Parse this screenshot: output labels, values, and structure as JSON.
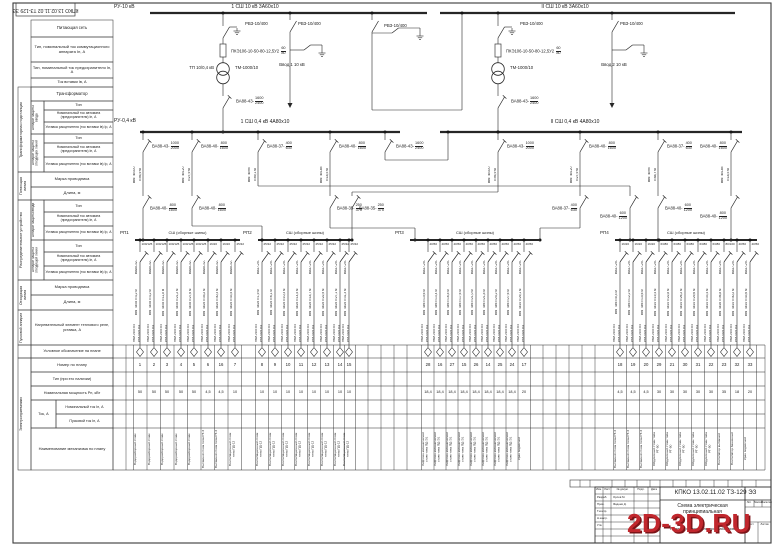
{
  "stamp": {
    "doc": "КПКО 13.02.11.02 ТЗ-129 ЭЗ"
  },
  "watermark": "2D-3D.RU",
  "hv": {
    "ru": "РУ-10 кВ",
    "bus1": "1 СШ 10 кВ  3А60х10",
    "bus2": "II СШ 10 кВ  3А60х10",
    "bays": [
      {
        "x": 223,
        "disc": "РВЗ-10/400",
        "fuse": "ПКЭ106-10-50-80-12,5У2",
        "fuse_frac": "60/80",
        "tp": "ТП 10/0,4 кВ",
        "tr": "ТМ-1000/10",
        "brk_t": "ВА88-43-",
        "brk_f": "1600/2400"
      },
      {
        "x": 498,
        "disc": "РВЗ-10/400",
        "fuse": "ПКЭ106-10-50-80-12,5У2",
        "fuse_frac": "60/80",
        "tp": "",
        "tr": "ТМ-1000/10",
        "brk_t": "ВА88-43-",
        "brk_f": "1600/2400"
      }
    ],
    "incomers": [
      {
        "x": 290,
        "disc": "РВЗ-10/400",
        "label": "Ввод 1 10 кВ"
      },
      {
        "x": 612,
        "disc": "РВЗ-10/400",
        "label": "Ввод 2 10 кВ"
      }
    ],
    "section": {
      "x": 372,
      "disc": "РВЗ-10/400"
    }
  },
  "lv": {
    "ru": "РУ-0,4 кВ",
    "bus1": "1 СШ 0,4 кВ  4А80х10",
    "bus2": "II СШ 0,4 кВ  4А80х10",
    "tie": {
      "t": "ВА88-43-",
      "f": "1600/2400"
    },
    "feeders": [
      {
        "x": 143,
        "top_t": "ВА88-43-",
        "top_f": "1000/2000",
        "cable": "ВВГ 4х300",
        "len": "l=56,9 м",
        "low_t": "ВА88-40-",
        "low_f": "800/1600",
        "route": "s",
        "land": 143
      },
      {
        "x": 192,
        "top_t": "ВА88-40-",
        "top_f": "800/1600",
        "cable": "ВВГ 4х120",
        "len": "l=27,9 м",
        "low_t": "ВА88-40-",
        "low_f": "800/1600",
        "route": "jog",
        "jy": 226,
        "land": 262
      },
      {
        "x": 258,
        "top_t": "ВА88-37-",
        "top_f": "400/630",
        "cable": "ВВГ 4х95",
        "len": "l=49,1 м",
        "low_t": "ВА88-40-",
        "low_f": "600/1200",
        "route": "H",
        "hy": 186,
        "land": 630
      },
      {
        "x": 330,
        "top_t": "ВА88-40-",
        "top_f": "800/1600",
        "cable": "ВВГ 4х185",
        "len": "l=18,5 м",
        "low_t": "ВА88-35-",
        "low_f": "250/375",
        "route": "jog",
        "jy": 228,
        "land": 415
      },
      {
        "x": 498,
        "top_t": "ВА88-43-",
        "top_f": "1000/2000",
        "cable": "ВВГ 4х300",
        "len": "l=56,9 м",
        "low_t": "ВА88-35-",
        "low_f": "250/375",
        "route": "H",
        "hy": 192,
        "land": 352
      },
      {
        "x": 580,
        "top_t": "ВА88-40-",
        "top_f": "800/1600",
        "cable": "ВВГ 4х120",
        "len": "l=27,9 м",
        "low_t": "ВА88-37-",
        "low_f": "400/630",
        "route": "jog",
        "jy": 228,
        "land": 540
      },
      {
        "x": 658,
        "top_t": "ВА88-37-",
        "top_f": "400/630",
        "cable": "ВВГ 4х95",
        "len": "l=48,7 м",
        "low_t": "ВА88-40-",
        "low_f": "600/1200",
        "route": "s",
        "land": 658
      },
      {
        "x": 731,
        "top_t": "ВА88-40-",
        "top_f": "800/1600",
        "cable": "ВВГ 4х185",
        "len": "l=18,5 м",
        "low_t": "ВА88-40-",
        "low_f": "800/1200",
        "route": "s",
        "land": 731
      }
    ]
  },
  "rp": {
    "starter1": "ПМЛ-2100 О4",
    "starter2": "РТЛ-1021 О4",
    "sections": [
      {
        "name": "РП1",
        "bus_label": "СШ (сборные шины)",
        "x1": 135,
        "x2": 240,
        "btype": "ВА88-32-",
        "cols": [
          {
            "x": 140,
            "frac": "100/125",
            "cable": "ВВГ 4х35 l=4,2 м",
            "num": "1",
            "pow": "50",
            "mech": "Водоразборный стояк"
          },
          {
            "x": 154,
            "frac": "100/125",
            "cable": "ВВГ 4х35 l=4,2 м",
            "num": "2",
            "pow": "50",
            "mech": "Водоразборный стояк"
          },
          {
            "x": 167,
            "frac": "100/125",
            "cable": "ВВГ 4х35 l=11,8 м",
            "num": "3",
            "pow": "50",
            "mech": "Водоразборный стояк"
          },
          {
            "x": 181,
            "frac": "100/125",
            "cable": "ВВГ 4х35 l=21,2 м",
            "num": "4",
            "pow": "50",
            "mech": "Водоразборный стояк"
          },
          {
            "x": 194,
            "frac": "100/125",
            "cable": "ВВГ 4х35 l=27,6 м",
            "num": "5",
            "pow": "50",
            "mech": "Водоразборный стояк"
          },
          {
            "x": 208,
            "frac": "16/20",
            "cable": "ВВГ 4х25 l=35,2 м",
            "num": "6",
            "pow": "4,5",
            "mech": "Вытяжной стояк типа РТ-3"
          },
          {
            "x": 221,
            "frac": "16/20",
            "cable": "ВВГ 4х25 l=40,3 м",
            "num": "16",
            "pow": "4,5",
            "mech": "Вытяжной стояк типа РТ-3"
          },
          {
            "x": 235,
            "frac": "25/32",
            "cable": "ВВГ 4х25 l=43,5 м",
            "num": "7",
            "pow": "10",
            "mech": "Вентиляционный стояк типа ПД-12"
          }
        ]
      },
      {
        "name": "РП2",
        "bus_label": "СШ (сборные шины)",
        "x1": 258,
        "x2": 352,
        "btype": "ВА47-29-",
        "cols": [
          {
            "x": 262,
            "frac": "25/32",
            "cable": "ВВГ 4х25 l=1,9 м",
            "num": "8",
            "pow": "10",
            "mech": "Вентиляционный стояк типа ПД-12"
          },
          {
            "x": 275,
            "frac": "25/32",
            "cable": "ВВГ 4х25 l=6,1 м",
            "num": "9",
            "pow": "10",
            "mech": "Вентиляционный стояк типа ПД-12"
          },
          {
            "x": 288,
            "frac": "25/32",
            "cable": "ВВГ 4х25 l=10,3 м",
            "num": "10",
            "pow": "10",
            "mech": "Вентиляционный стояк типа ПД-12"
          },
          {
            "x": 301,
            "frac": "25/32",
            "cable": "ВВГ 4х25 l=14,5 м",
            "num": "11",
            "pow": "10",
            "mech": "Вентиляционный стояк типа ПД-12"
          },
          {
            "x": 314,
            "frac": "25/32",
            "cable": "ВВГ 4х25 l=18,7 м",
            "num": "12",
            "pow": "10",
            "mech": "Вентиляционный стояк типа ПД-12"
          },
          {
            "x": 327,
            "frac": "25/32",
            "cable": "ВВГ 4х25 l=22,9 м",
            "num": "13",
            "pow": "10",
            "mech": "Вентиляционный стояк типа ПД-12"
          },
          {
            "x": 340,
            "frac": "25/32",
            "cable": "ВВГ 4х25 l=27,1 м",
            "num": "14",
            "pow": "10",
            "mech": "Вентиляционный стояк типа ПД-12"
          },
          {
            "x": 349,
            "frac": "25/32",
            "cable": "ВВГ 4х25 l=31,3 м",
            "num": "15",
            "pow": "10",
            "mech": "Вентиляционный стояк типа ПД-12"
          }
        ]
      },
      {
        "name": "РП3",
        "bus_label": "СШ (сборные шины)",
        "x1": 410,
        "x2": 540,
        "btype": "ВА47-29-",
        "cols": [
          {
            "x": 428,
            "frac": "40/50",
            "cable": "ВВГ 4х6 l=10,6 м",
            "num": "28",
            "pow": "18,4",
            "mech": "Лифтово-механический стояк типа ПД-Э1"
          },
          {
            "x": 440,
            "frac": "40/50",
            "cable": "ВВГ 4х6 l=13,4 м",
            "num": "16",
            "pow": "18,4",
            "mech": "Лифтово-механический стояк типа ПД-Э1"
          },
          {
            "x": 452,
            "frac": "40/50",
            "cable": "ВВГ 4х6 l=16,8 м",
            "num": "27",
            "pow": "18,4",
            "mech": "Лифтово-механический стояк типа ПД-Э1"
          },
          {
            "x": 464,
            "frac": "40/50",
            "cable": "ВВГ 4х6 l=17,6 м",
            "num": "15",
            "pow": "18,4",
            "mech": "Лифтово-механический стояк типа ПД-Э1"
          },
          {
            "x": 476,
            "frac": "40/50",
            "cable": "ВВГ 4х6 l=21,0 м",
            "num": "26",
            "pow": "18,4",
            "mech": "Лифтово-механический стояк типа ПД-Э1"
          },
          {
            "x": 488,
            "frac": "40/50",
            "cable": "ВВГ 4х6 l=21,8 м",
            "num": "14",
            "pow": "18,4",
            "mech": "Лифтово-механический стояк типа ПД-Э1"
          },
          {
            "x": 500,
            "frac": "40/50",
            "cable": "ВВГ 4х6 l=25,2 м",
            "num": "25",
            "pow": "18,4",
            "mech": "Лифтово-механический стояк типа ПД-Э1"
          },
          {
            "x": 512,
            "frac": "40/50",
            "cable": "ВВГ 4х6 l=27,6 м",
            "num": "24",
            "pow": "18,4",
            "mech": "Лифтово-механический стояк типа ПД-Э1"
          },
          {
            "x": 524,
            "frac": "40/50",
            "cable": "ВВГ 4х10 l=29,1 м",
            "num": "17",
            "pow": "20",
            "mech": "Кран подвесной"
          }
        ]
      },
      {
        "name": "РП4",
        "bus_label": "СШ (сборные шины)",
        "x1": 615,
        "x2": 757,
        "btype": "ВА47-29-",
        "cols": [
          {
            "x": 620,
            "frac": "16/20",
            "cable": "ВВГ 4х6 l=8,4 м",
            "num": "18",
            "pow": "4,5",
            "mech": "Вытяжной стояк типа РТ-3"
          },
          {
            "x": 633,
            "frac": "16/20",
            "cable": "ВВГ 4х6 l=12,2 м",
            "num": "19",
            "pow": "4,5",
            "mech": "Вытяжной стояк типа РТ-3"
          },
          {
            "x": 646,
            "frac": "16/20",
            "cable": "ВВГ 4х6 l=15,6 м",
            "num": "20",
            "pow": "4,5",
            "mech": "Вытяжной стояк типа РТ-3"
          },
          {
            "x": 659,
            "frac": "63/80",
            "cable": "ВВГ 4х10 l=19,4 м",
            "num": "29",
            "pow": "30",
            "mech": "Обдувочный стояк типа РТ-50"
          },
          {
            "x": 672,
            "frac": "63/80",
            "cable": "ВВГ 4х10 l=22,8 м",
            "num": "21",
            "pow": "30",
            "mech": "Обдувочный стояк типа РТ-50"
          },
          {
            "x": 685,
            "frac": "63/80",
            "cable": "ВВГ 4х10 l=26,2 м",
            "num": "30",
            "pow": "30",
            "mech": "Обдувочный стояк типа РТ-50"
          },
          {
            "x": 698,
            "frac": "63/80",
            "cable": "ВВГ 4х10 l=29,6 м",
            "num": "31",
            "pow": "30",
            "mech": "Обдувочный стояк типа РТ-50"
          },
          {
            "x": 711,
            "frac": "63/80",
            "cable": "ВВГ 4х10 l=33,4 м",
            "num": "22",
            "pow": "30",
            "mech": "Обдувочный стояк типа РТ-50"
          },
          {
            "x": 724,
            "frac": "80/100",
            "cable": "ВВГ 4х16 l=36,8 м",
            "num": "23",
            "pow": "35",
            "mech": "Вентилятор вытяжной"
          },
          {
            "x": 737,
            "frac": "40/50",
            "cable": "ВВГ 4х10 l=40,2 м",
            "num": "32",
            "pow": "18",
            "mech": "Вентилятор башенный"
          },
          {
            "x": 750,
            "frac": "40/50",
            "cable": "ВВГ 4х10 l=43,6 м",
            "num": "33",
            "pow": "20",
            "mech": "Кран подвесной"
          }
        ]
      }
    ]
  },
  "lt": {
    "g_tp": "Трансформаторная подстанция",
    "g_line": "Питающая линия",
    "g_ru": "Распределительное устройство",
    "g_outline": "Отходящая линия",
    "g_start": "Пусковой аппарат",
    "g_el": "Электроприемники",
    "s_in": "Аппарат защиты ввода",
    "s_out": "Аппарат защиты отходящих линий",
    "s_out2": "Аппарат защиты отходящей линии",
    "r_feed": "Питающая сеть",
    "r_sw": "Тип, номинальный ток коммутационного аппарата Iн, А",
    "r_fuse": "Тип, номинальный ток предохранителя Iн, А",
    "r_fuse2": "Ток вставки Iв, А",
    "r_tr": "Трансформатор",
    "r_type": "Тип",
    "r_nom": "Номинальный ток автомата (предохранителя) Iн, А",
    "r_ust": "Уставка расцепителя (ток вставки Iв) Iр, А",
    "r_mark": "Марка проводника",
    "r_len": "Длина, м",
    "r_heater": "Нагревательный элемент теплового реле, уставка, А",
    "r_sym": "Условное обозначение на плане",
    "r_num": "Номер по плану",
    "r_typ2": "Тип (при его наличии)",
    "r_pow": "Номинальная мощность Рн, кВт",
    "r_tok": "Ток, А",
    "r_inom": "Номинальный ток Iн, А",
    "r_ipusk": "Пусковой ток Iп, А",
    "r_mech": "Наименование механизма по плану"
  },
  "tb": {
    "doc": "КПКО 13.02.11.02 ТЗ-129 ЭЗ",
    "title": "Схема электрическая принципиальная",
    "object": "Проектирование, электроснабжение",
    "cols": [
      "Изм.",
      "Лист",
      "№ докум.",
      "Подп.",
      "Дата"
    ],
    "rows": [
      [
        "Разраб.",
        "Орлов М."
      ],
      [
        "Пров.",
        "Фадеев Д."
      ],
      [
        "Т.контр.",
        ""
      ],
      [
        "Н.контр.",
        ""
      ],
      [
        "Утв.",
        ""
      ]
    ],
    "lit": "Лит.",
    "mass": "Масса",
    "scale": "Масштаб",
    "sheet": "Лист",
    "sheets": "Листов"
  }
}
